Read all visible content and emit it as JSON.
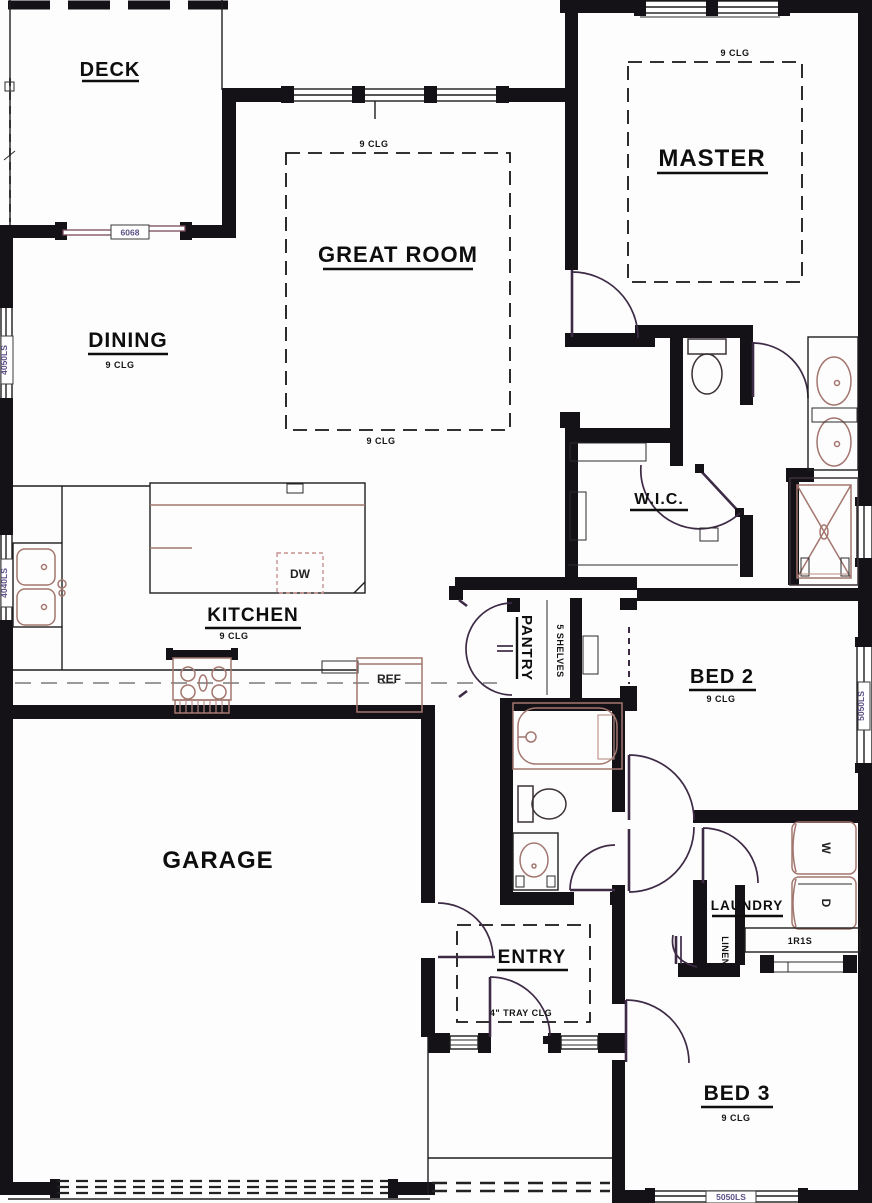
{
  "rooms": {
    "deck": {
      "label": "DECK"
    },
    "great_room": {
      "label": "GREAT ROOM",
      "clg_top": "9 CLG",
      "clg_bottom": "9 CLG"
    },
    "master": {
      "label": "MASTER",
      "clg": "9 CLG"
    },
    "dining": {
      "label": "DINING",
      "clg": "9 CLG"
    },
    "kitchen": {
      "label": "KITCHEN",
      "clg": "9 CLG"
    },
    "wic": {
      "label": "W.I.C."
    },
    "pantry": {
      "label": "PANTRY",
      "shelves": "5 SHELVES"
    },
    "bed2": {
      "label": "BED 2",
      "clg": "9 CLG"
    },
    "garage": {
      "label": "GARAGE"
    },
    "entry": {
      "label": "ENTRY",
      "clg": "4\" TRAY CLG"
    },
    "laundry": {
      "label": "LAUNDRY"
    },
    "linen": {
      "label": "LINEN"
    },
    "stairs": {
      "label": "1R1S"
    },
    "bed3": {
      "label": "BED 3",
      "clg": "9 CLG"
    }
  },
  "appliances": {
    "dishwasher": "DW",
    "refrigerator": "REF",
    "washer": "W",
    "dryer": "D"
  },
  "windows": {
    "deck_door": "6068",
    "dining": "4050LS",
    "kitchen": "4040LS",
    "bed2": "5050LS",
    "bed3": "5050LS"
  },
  "colors": {
    "wall": "#151217",
    "fixture": "#a3766f",
    "door_swing": "#3d2a45",
    "window_label": "#5c5086"
  }
}
